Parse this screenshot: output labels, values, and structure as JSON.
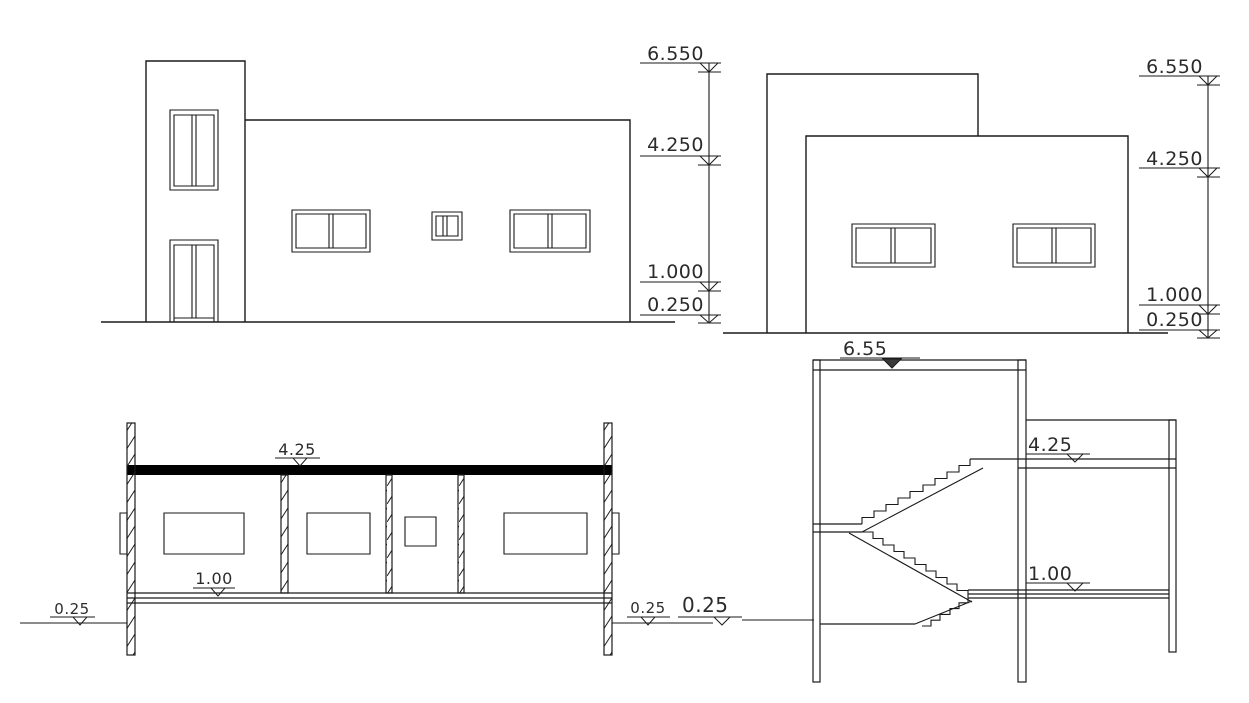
{
  "sheet": {
    "background_color": "#ffffff",
    "line_color": "#1a1a1a",
    "slab_fill_color": "#000000"
  },
  "front_elevation": {
    "levels": [
      {
        "label": "6.550"
      },
      {
        "label": "4.250"
      },
      {
        "label": "1.000"
      },
      {
        "label": "0.250"
      }
    ]
  },
  "side_elevation": {
    "levels": [
      {
        "label": "6.550"
      },
      {
        "label": "4.250"
      },
      {
        "label": "1.000"
      },
      {
        "label": "0.250"
      }
    ]
  },
  "cross_section": {
    "roof_level": "4.25",
    "floor_level": "1.00",
    "ground_level_left": "0.25",
    "ground_level_right": "0.25"
  },
  "stair_section": {
    "ground_level": "0.25",
    "roof_level": "6.55",
    "upper_floor_level": "4.25",
    "first_floor_level": "1.00"
  }
}
